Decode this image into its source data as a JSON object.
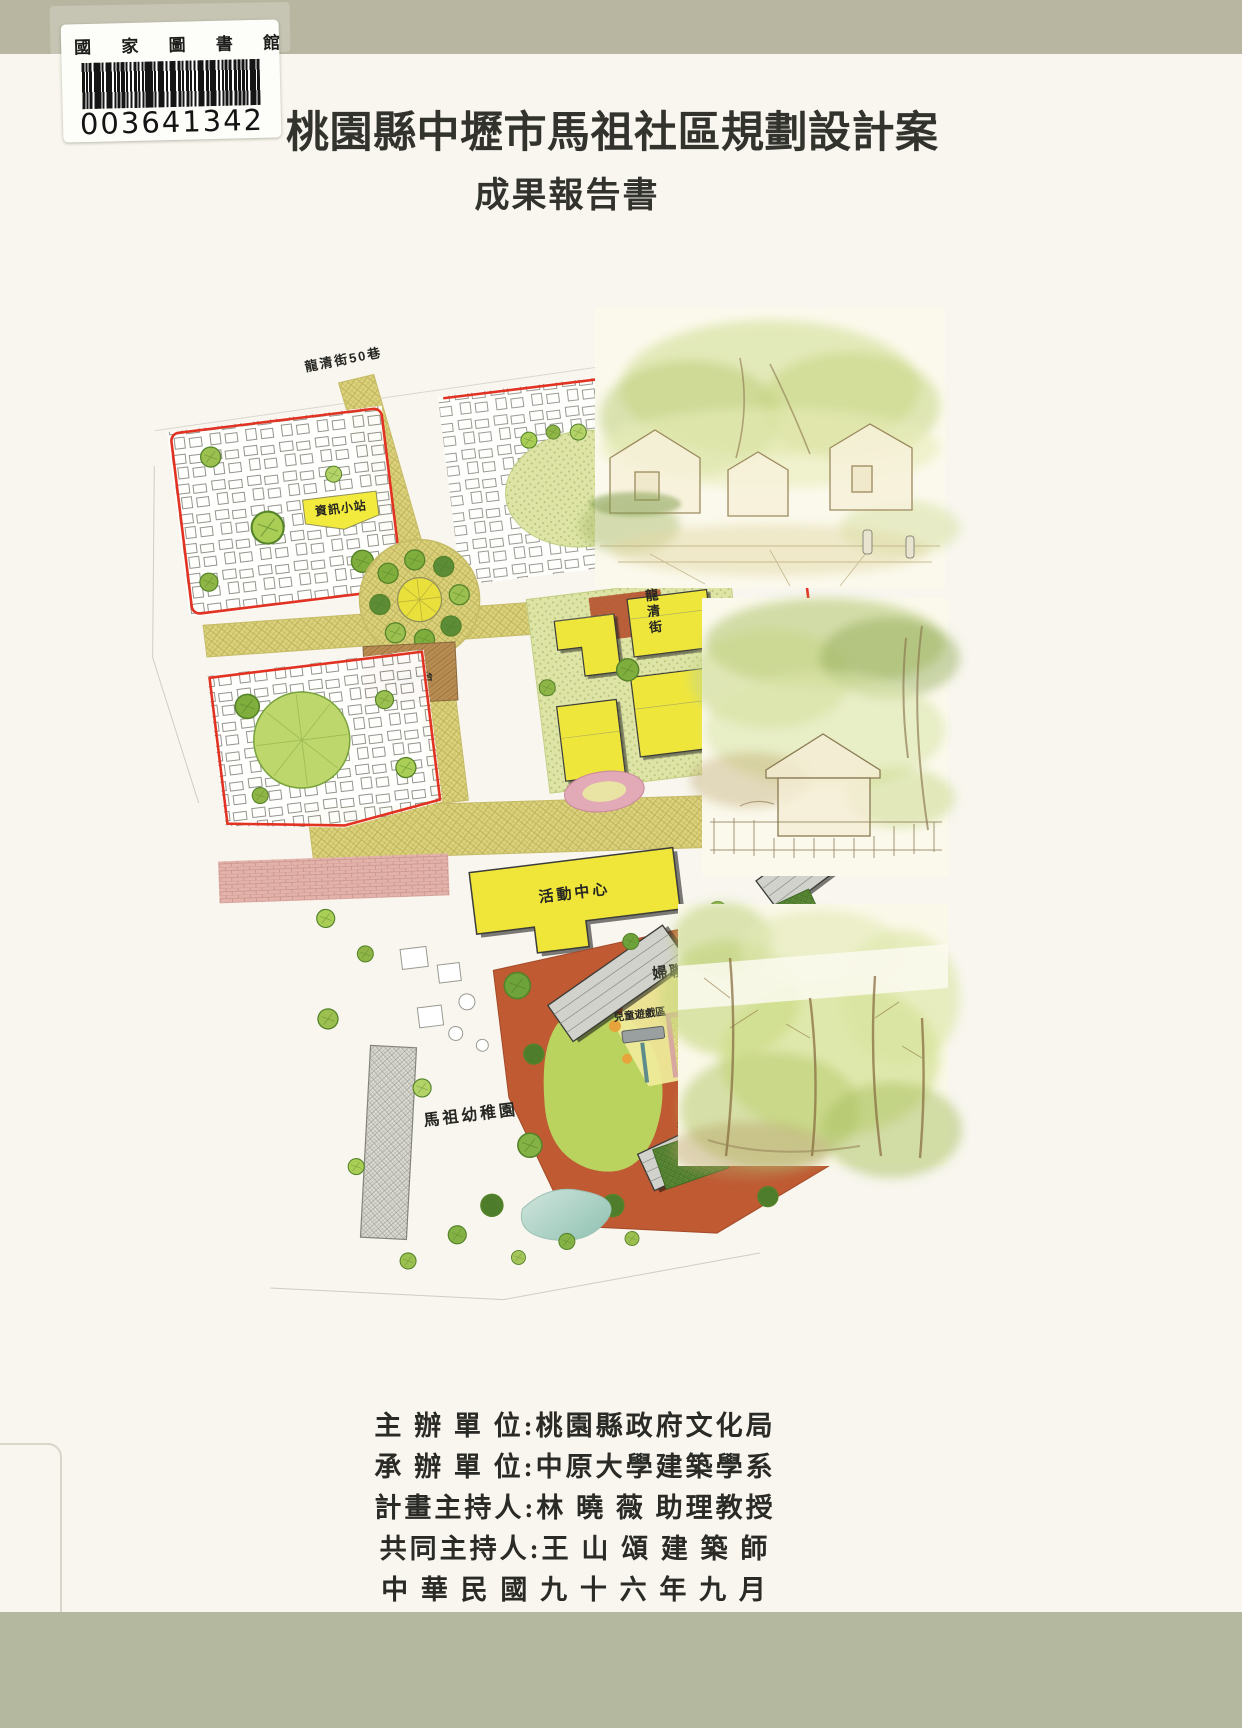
{
  "cover": {
    "library_sticker": {
      "institution": "國 家 圖 書 館",
      "barcode_number": "003641342"
    },
    "title": "桃園縣中壢市馬祖社區規劃設計案",
    "subtitle": "成果報告書",
    "credits": [
      "主 辦 單 位:桃園縣政府文化局",
      "承 辦 單 位:中原大學建築學系",
      "計畫主持人:林 曉 薇 助理教授",
      "共同主持人:王 山 頌 建 築 師",
      "中 華 民 國 九 十 六 年 九 月"
    ]
  },
  "site_plan": {
    "labels": {
      "street_top": "龍清街50巷",
      "street_right": "龍清街",
      "info_station": "資訊小站",
      "rest_deck": "休憩平台",
      "activity_center": "活動中心",
      "kindergarten": "馬祖幼稚園",
      "womens_league_park": "婦聯會公園",
      "central_plaza": "中央廣場",
      "children_play_area": "兒童遊戲區",
      "shaded_walkway": "林蔭步道",
      "croquet_court": "槌球場"
    }
  },
  "colors": {
    "top_band": "#b8b5a0",
    "bottom_band": "#b4b89e",
    "paper": "#f8f6ee",
    "boundary_red": "#e23222",
    "road_khaki": "#dcd27c",
    "building_yellow": "#efe63c",
    "plaza_terracotta": "#bf5a33",
    "brick_pink": "#e3b3ab",
    "court_green": "#5d8c36"
  }
}
